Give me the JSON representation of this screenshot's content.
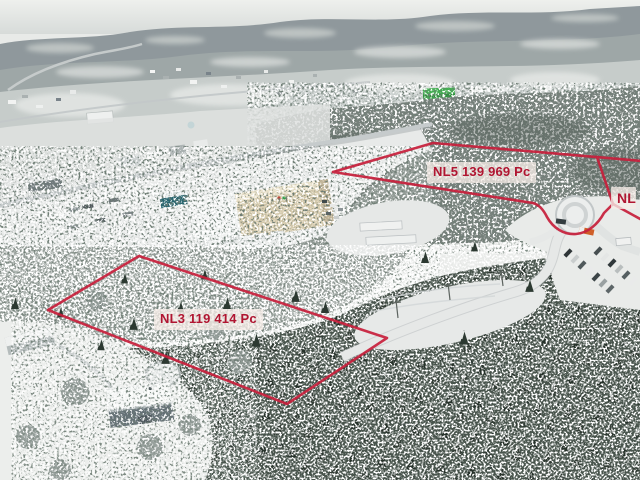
{
  "image": {
    "description": "Winter aerial drone photograph of wooded commercial lots for sale at the edge of a snowy town, marked with red boundary overlays",
    "season": "winter"
  },
  "annotations": {
    "line_color": "#c7203c",
    "label_bg": "rgba(245,236,231,0.78)",
    "label_text_color": "#b01531",
    "lots": [
      {
        "id": "NL5",
        "area_pc": "139 969",
        "label": "NL5 139 969 Pc"
      },
      {
        "id": "NL3",
        "area_pc": "119 414",
        "label": "NL3 119 414 Pc"
      },
      {
        "id": "NL",
        "area_pc": "",
        "label": "NL"
      }
    ]
  },
  "scene_colors": {
    "sky": "#e9ebe8",
    "far_hills": "#8f989c",
    "snow": "#e9ebe9",
    "conifer_forest": "#48544c",
    "mixed_forest": "#99a29d",
    "warehouse_tan": "#d6cbae",
    "teal_building": "#27656f",
    "green_building": "#3fae4e",
    "orange_truck": "#cf5f28"
  }
}
